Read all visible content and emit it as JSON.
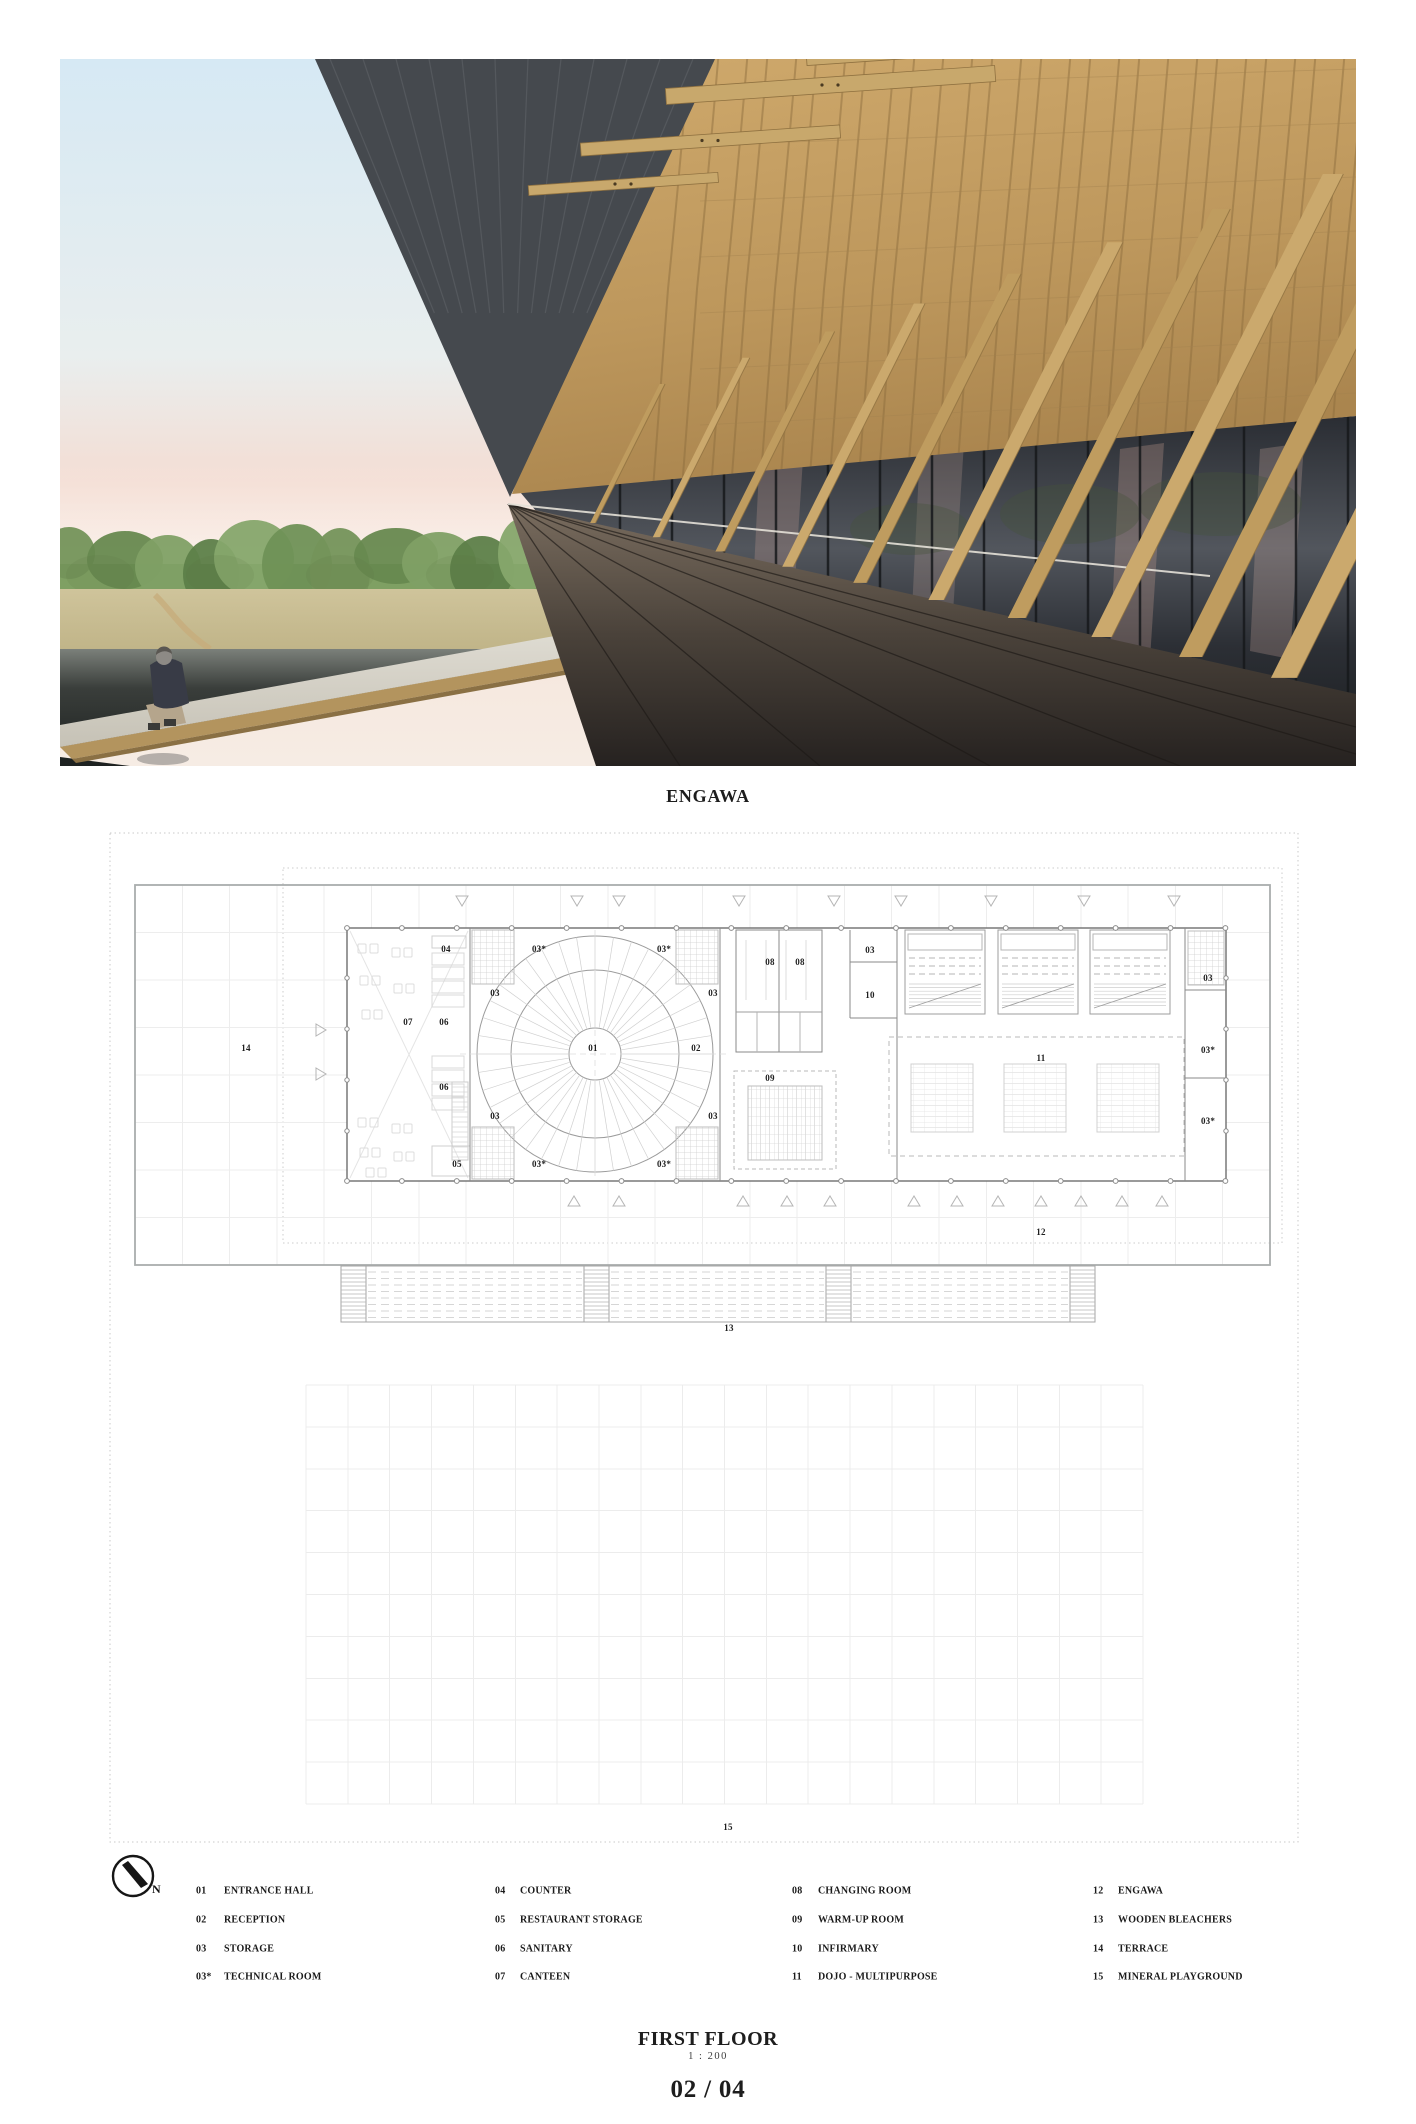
{
  "photo": {
    "caption": "ENGAWA"
  },
  "titleblock": {
    "title": "FIRST FLOOR",
    "scale": "1 : 200",
    "page_number": "02 / 04"
  },
  "north_label": "N",
  "plan_labels": [
    {
      "t": "14",
      "x": 246,
      "y": 1048
    },
    {
      "t": "04",
      "x": 446,
      "y": 949
    },
    {
      "t": "07",
      "x": 408,
      "y": 1022
    },
    {
      "t": "06",
      "x": 444,
      "y": 1022
    },
    {
      "t": "06",
      "x": 444,
      "y": 1087
    },
    {
      "t": "05",
      "x": 457,
      "y": 1164
    },
    {
      "t": "03",
      "x": 495,
      "y": 993
    },
    {
      "t": "03",
      "x": 495,
      "y": 1116
    },
    {
      "t": "03*",
      "x": 539,
      "y": 949
    },
    {
      "t": "03*",
      "x": 539,
      "y": 1164
    },
    {
      "t": "03*",
      "x": 664,
      "y": 949
    },
    {
      "t": "03*",
      "x": 664,
      "y": 1164
    },
    {
      "t": "01",
      "x": 593,
      "y": 1048
    },
    {
      "t": "02",
      "x": 696,
      "y": 1048
    },
    {
      "t": "03",
      "x": 713,
      "y": 993
    },
    {
      "t": "03",
      "x": 713,
      "y": 1116
    },
    {
      "t": "08",
      "x": 770,
      "y": 962
    },
    {
      "t": "08",
      "x": 800,
      "y": 962
    },
    {
      "t": "03",
      "x": 870,
      "y": 950
    },
    {
      "t": "10",
      "x": 870,
      "y": 995
    },
    {
      "t": "09",
      "x": 770,
      "y": 1078
    },
    {
      "t": "11",
      "x": 1041,
      "y": 1058
    },
    {
      "t": "03",
      "x": 1208,
      "y": 978
    },
    {
      "t": "03*",
      "x": 1208,
      "y": 1050
    },
    {
      "t": "03*",
      "x": 1208,
      "y": 1121
    },
    {
      "t": "12",
      "x": 1041,
      "y": 1232
    },
    {
      "t": "13",
      "x": 729,
      "y": 1328
    },
    {
      "t": "15",
      "x": 728,
      "y": 1827
    }
  ],
  "legend": {
    "row_y": [
      1891,
      1920,
      1949,
      1977
    ],
    "columns": [
      {
        "num_x": 196,
        "label_x": 224,
        "items": [
          {
            "num": "01",
            "label": "ENTRANCE HALL"
          },
          {
            "num": "02",
            "label": "RECEPTION"
          },
          {
            "num": "03",
            "label": "STORAGE"
          },
          {
            "num": "03*",
            "label": "TECHNICAL ROOM"
          }
        ]
      },
      {
        "num_x": 495,
        "label_x": 520,
        "items": [
          {
            "num": "04",
            "label": "COUNTER"
          },
          {
            "num": "05",
            "label": "RESTAURANT STORAGE"
          },
          {
            "num": "06",
            "label": "SANITARY"
          },
          {
            "num": "07",
            "label": "CANTEEN"
          }
        ]
      },
      {
        "num_x": 792,
        "label_x": 818,
        "items": [
          {
            "num": "08",
            "label": "CHANGING ROOM"
          },
          {
            "num": "09",
            "label": "WARM-UP ROOM"
          },
          {
            "num": "10",
            "label": "INFIRMARY"
          },
          {
            "num": "11",
            "label": "DOJO - MULTIPURPOSE"
          }
        ]
      },
      {
        "num_x": 1093,
        "label_x": 1118,
        "items": [
          {
            "num": "12",
            "label": "ENGAWA"
          },
          {
            "num": "13",
            "label": "WOODEN BLEACHERS"
          },
          {
            "num": "14",
            "label": "TERRACE"
          },
          {
            "num": "15",
            "label": "MINERAL PLAYGROUND"
          }
        ]
      }
    ]
  },
  "colors": {
    "wood": "#c8a86c",
    "shingle": "#b8915a",
    "soffit": "#45494e",
    "deck_dark": "#2a2522",
    "sky_top": "#d6e9f4",
    "sky_horizon": "#f4ddd3",
    "foliage": "#7d9c60",
    "pond": "#2f3330",
    "ink": "#1c1c1c",
    "plan_line": "#9aa0a0",
    "grid_line": "#ececec"
  }
}
